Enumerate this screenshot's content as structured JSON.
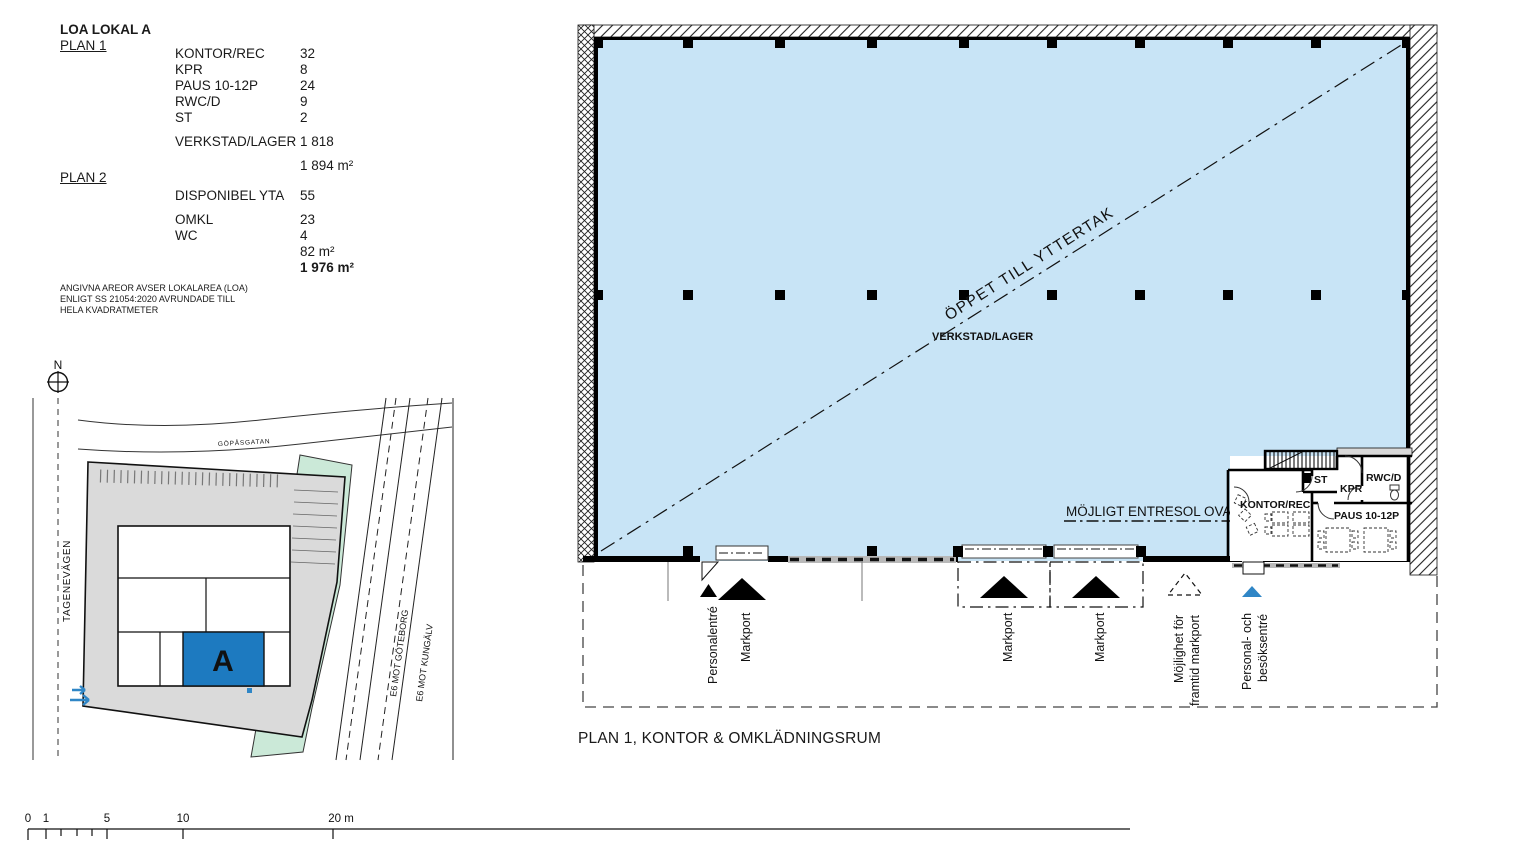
{
  "legend": {
    "title": "LOA LOKAL A",
    "plan1": {
      "label": "PLAN 1",
      "rows": [
        {
          "label": "KONTOR/REC",
          "value": "32"
        },
        {
          "label": "KPR",
          "value": "8"
        },
        {
          "label": "PAUS 10-12P",
          "value": "24"
        },
        {
          "label": "RWC/D",
          "value": "9"
        },
        {
          "label": "ST",
          "value": "2"
        }
      ],
      "hall_row": {
        "label": "VERKSTAD/LAGER",
        "value": "1 818"
      },
      "subtotal": "1 894 m²"
    },
    "plan2": {
      "label": "PLAN 2",
      "rows": [
        {
          "label": "DISPONIBEL YTA",
          "value": "55"
        },
        {
          "label": "OMKL",
          "value": "23"
        },
        {
          "label": "WC",
          "value": "4"
        }
      ],
      "subtotal": "82 m²",
      "total": "1 976 m²"
    },
    "note_lines": [
      "ANGIVNA AREOR AVSER LOKALAREA (LOA)",
      "ENLIGT SS 21054:2020 AVRUNDADE TILL",
      "HELA KVADRATMETER"
    ]
  },
  "site_map": {
    "north_label": "N",
    "street_top": "GÖPÅSGATAN",
    "street_left": "TAGENEVÄGEN",
    "highway_1": "E6 MOT GÖTEBORG",
    "highway_2": "E6 MOT KUNGÄLV",
    "building_label": "A"
  },
  "floor_plan": {
    "open_to_roof": "ÖPPET TILL YTTERTAK",
    "hall_label": "VERKSTAD/LAGER",
    "entresol_label": "MÖJLIGT ENTRESOL OVAN",
    "rooms": {
      "kontor": "KONTOR/REC",
      "st": "ST",
      "kpr": "KPR",
      "rwc": "RWC/D",
      "paus": "PAUS 10-12P"
    },
    "entrances": [
      "Personalentré",
      "Markport",
      "Markport",
      "Markport"
    ],
    "future_port": {
      "line1": "Möjlighet för",
      "line2": "framtid markport"
    },
    "visitor_entrance": {
      "line1": "Personal- och",
      "line2": "besöksentré"
    }
  },
  "plan_title": "PLAN 1, KONTOR & OMKLÄDNINGSRUM",
  "scale_bar": {
    "labels": [
      "0",
      "1",
      "5",
      "10",
      "20 m"
    ]
  },
  "colors": {
    "hall_blue": "#c8e4f6",
    "highlight_blue": "#1d7ac0",
    "site_green": "#cbe9d8",
    "site_grey": "#dadada",
    "entry_arrow_blue": "#2f86c6"
  }
}
